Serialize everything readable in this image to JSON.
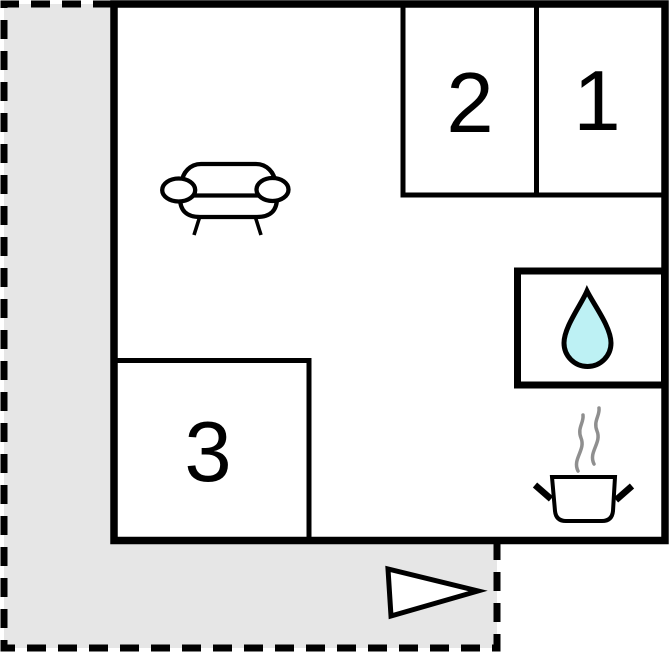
{
  "floorplan": {
    "rooms": [
      {
        "name": "room-1",
        "label": "1"
      },
      {
        "name": "room-2",
        "label": "2"
      },
      {
        "name": "room-3",
        "label": "3"
      }
    ],
    "icons": {
      "sofa": "sofa-icon",
      "water_drop": "water-drop-icon",
      "cooking_pot": "cooking-pot-icon",
      "steam": "steam-icon",
      "entrance_arrow": "entrance-arrow-icon"
    },
    "colors": {
      "terrace": "#e6e6e6",
      "water_drop": "#bdf1f4",
      "wall": "#000000",
      "steam": "#8f8f8f",
      "background": "#ffffff"
    }
  }
}
